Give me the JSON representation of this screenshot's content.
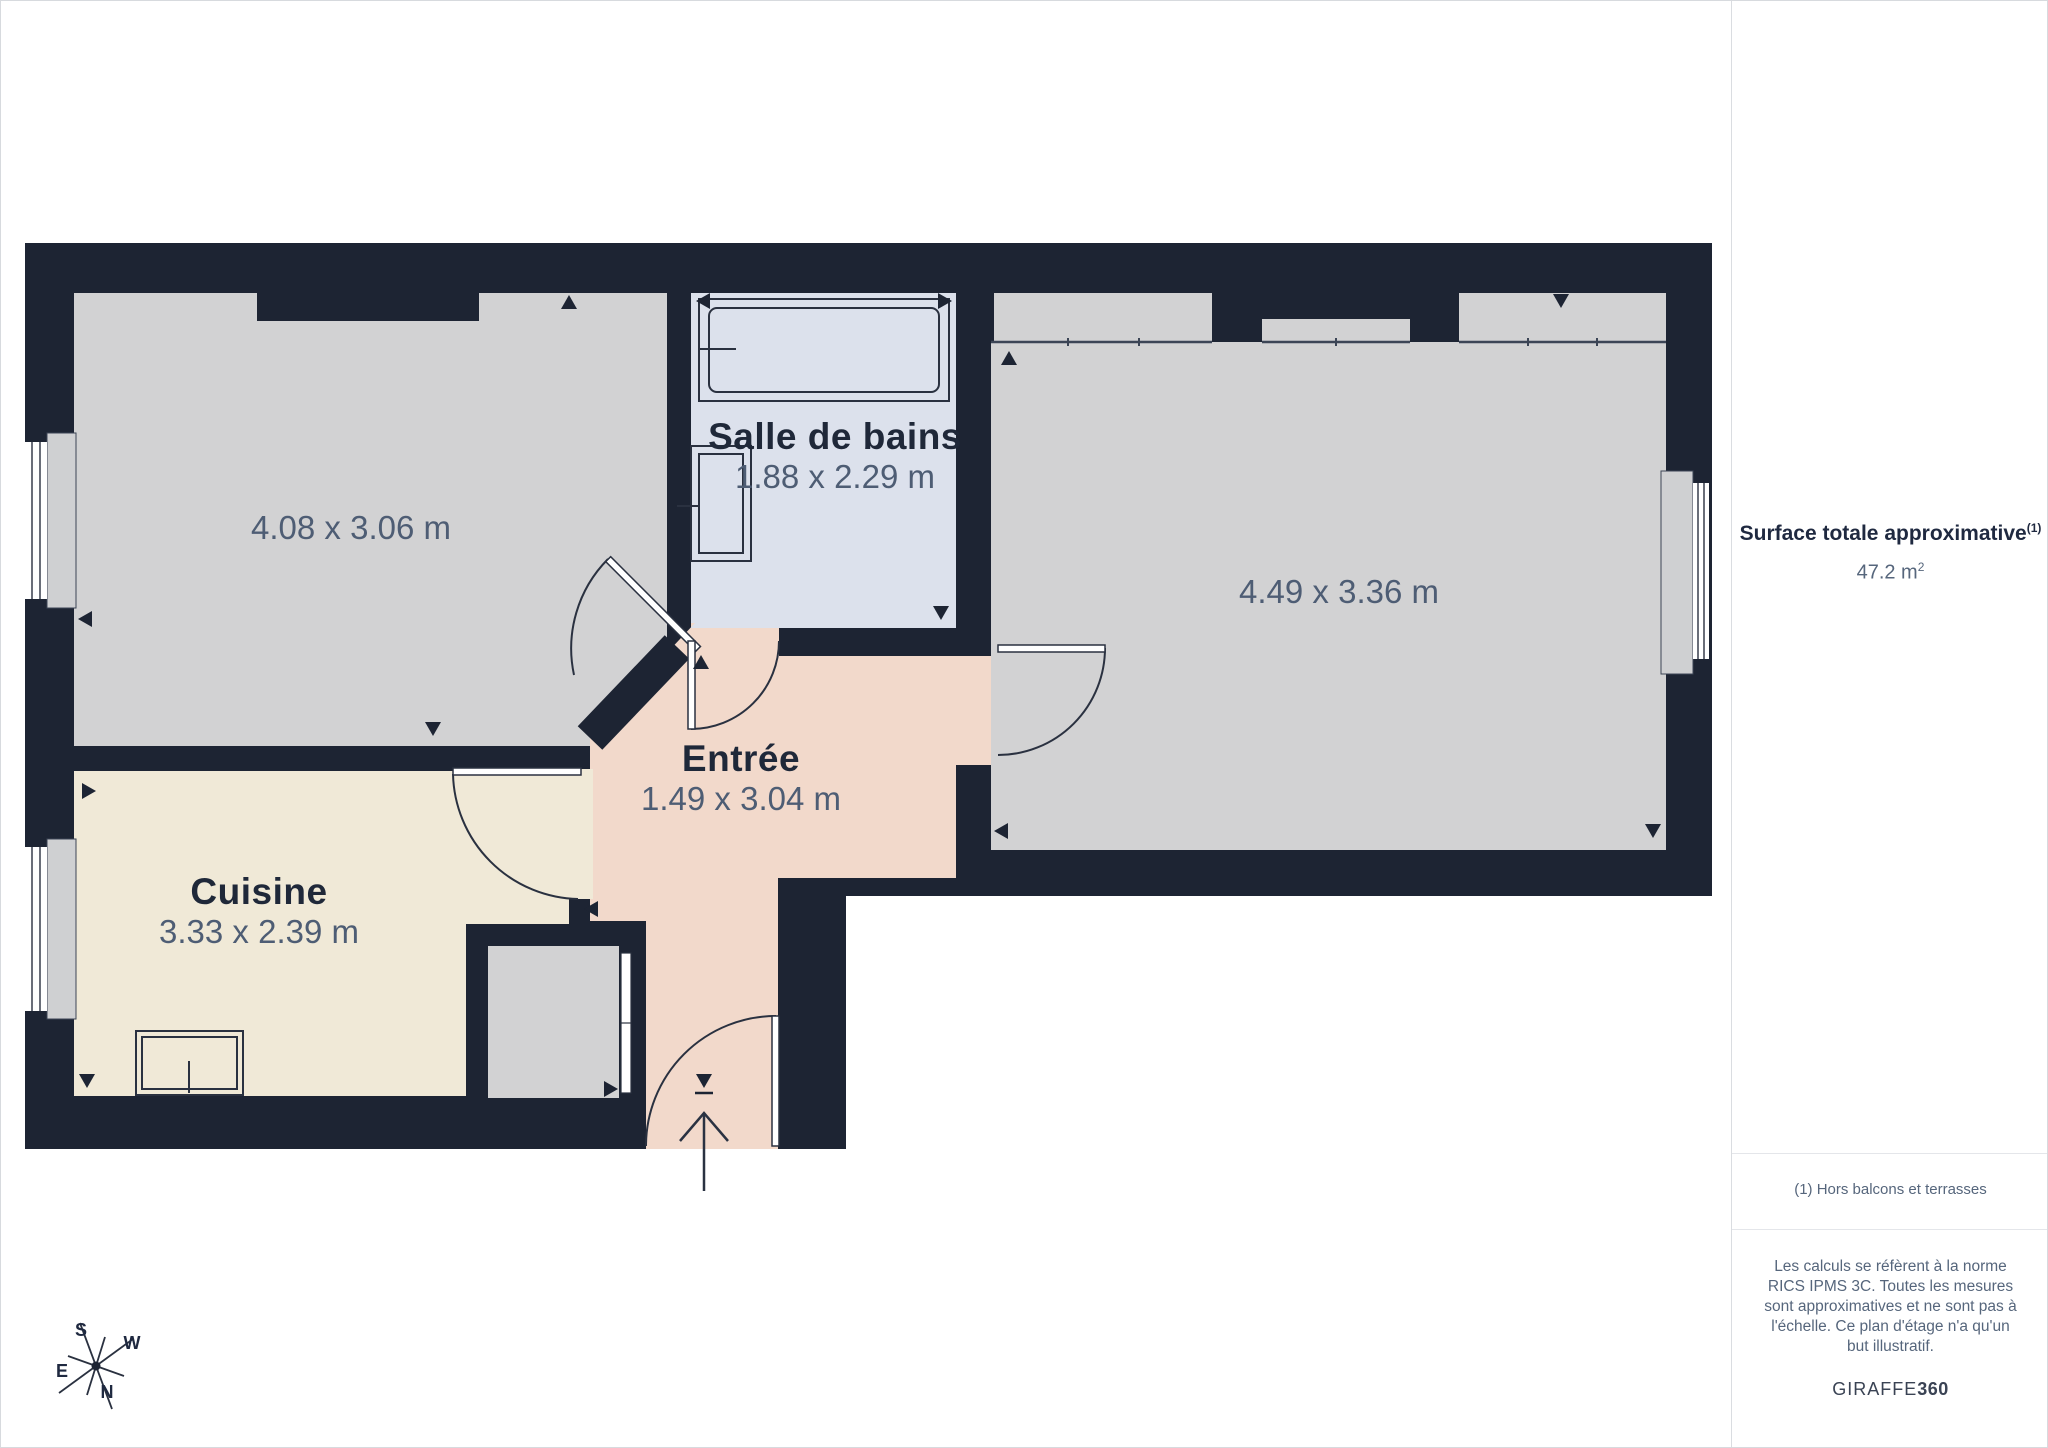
{
  "floor_plan": {
    "wall_color": "#1d2433",
    "rooms": [
      {
        "id": "living-room",
        "label": "",
        "dimensions": "4.08 x 3.06 m",
        "floor_color": "#d2d2d3"
      },
      {
        "id": "bathroom",
        "label": "Salle de bains",
        "dimensions": "1.88 x 2.29 m",
        "floor_color": "#dce1ec"
      },
      {
        "id": "bedroom",
        "label": "",
        "dimensions": "4.49 x 3.36 m",
        "floor_color": "#d2d2d3"
      },
      {
        "id": "kitchen",
        "label": "Cuisine",
        "dimensions": "3.33 x 2.39 m",
        "floor_color": "#f0e9d7"
      },
      {
        "id": "entry",
        "label": "Entrée",
        "dimensions": "1.49 x 3.04 m",
        "floor_color": "#f2d9cb"
      }
    ],
    "compass": {
      "north": "N",
      "south": "S",
      "east": "E",
      "west": "W"
    }
  },
  "sidebar": {
    "total_area_label": "Surface totale approximative",
    "total_area_superscript": "(1)",
    "total_area_value": "47.2 m",
    "total_area_exponent": "2",
    "footnote": "(1) Hors balcons et terrasses",
    "disclaimer": "Les calculs se réfèrent à la norme RICS IPMS 3C. Toutes les mesures sont approximatives et ne sont pas à l'échelle. Ce plan d'étage n'a qu'un but illustratif.",
    "brand_name": "GIRAFFE",
    "brand_suffix": "360"
  }
}
